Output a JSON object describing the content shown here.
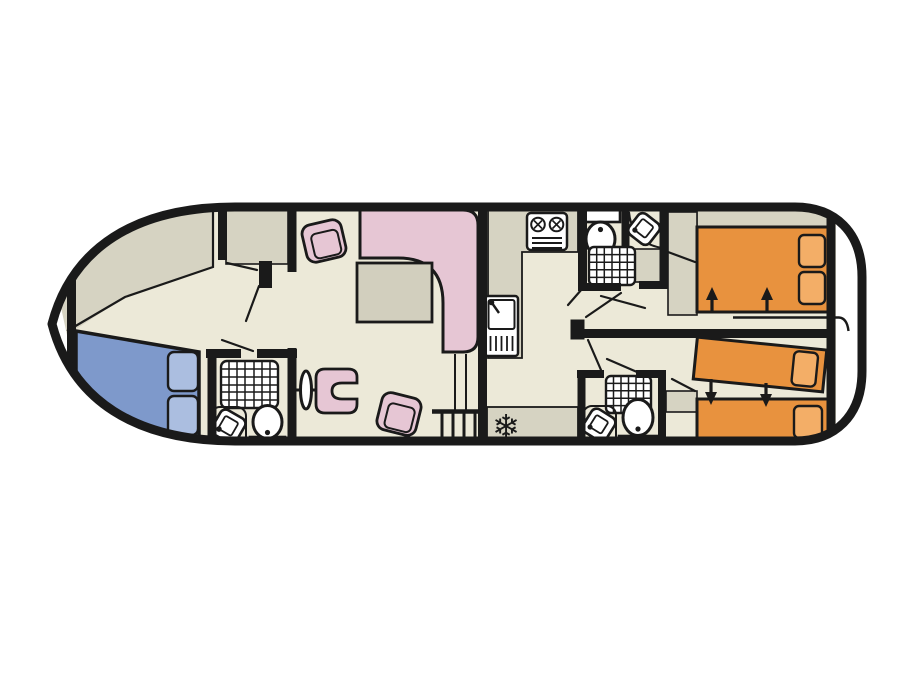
{
  "palette": {
    "background": "#ffffff",
    "wall": "#1a1a1a",
    "floor": "#ece9d8",
    "deck_gray": "#d6d3c2",
    "table_gray": "#d2cfbe",
    "sofa_pink": "#e6c6d4",
    "bed_orange": "#e8923e",
    "pillow_orange": "#f3ae67",
    "bed_blue": "#7e99cb",
    "pillow_blue": "#abbee0",
    "fixture_white": "#ffffff"
  },
  "icons": {
    "freezer_glyph": "❄"
  },
  "floor_plan": {
    "vessel": "motor-cruiser deck plan",
    "orientation": "bow left, stern right",
    "areas": [
      {
        "name": "bow-deck",
        "features": [
          "open deck"
        ]
      },
      {
        "name": "bow-cabin",
        "features": [
          "double bed",
          "2 pillows",
          "wardrobe"
        ]
      },
      {
        "name": "bow-bathroom",
        "features": [
          "shower",
          "corner washbasin",
          "toilet"
        ]
      },
      {
        "name": "helm",
        "features": [
          "steering wheel",
          "helm seat"
        ]
      },
      {
        "name": "saloon",
        "features": [
          "L-shaped sofa",
          "table",
          "2 chairs"
        ]
      },
      {
        "name": "galley",
        "features": [
          "2-burner hob",
          "sink with drainer",
          "worktop",
          "refrigerator",
          "companionway steps"
        ]
      },
      {
        "name": "forward-shower-room",
        "features": [
          "toilet",
          "shower",
          "corner washbasin",
          "wardrobe"
        ]
      },
      {
        "name": "aft-shower-room",
        "features": [
          "shower",
          "corner washbasin",
          "toilet"
        ]
      },
      {
        "name": "aft-cabin-port",
        "features": [
          "double bed",
          "2 pillows",
          "wardrobe",
          "sliding partition"
        ]
      },
      {
        "name": "aft-cabin-starboard",
        "features": [
          "2 convertible single beds",
          "2 pillows",
          "wardrobe"
        ]
      },
      {
        "name": "corridor",
        "features": [
          "doors to cabins and shower rooms"
        ]
      }
    ]
  }
}
